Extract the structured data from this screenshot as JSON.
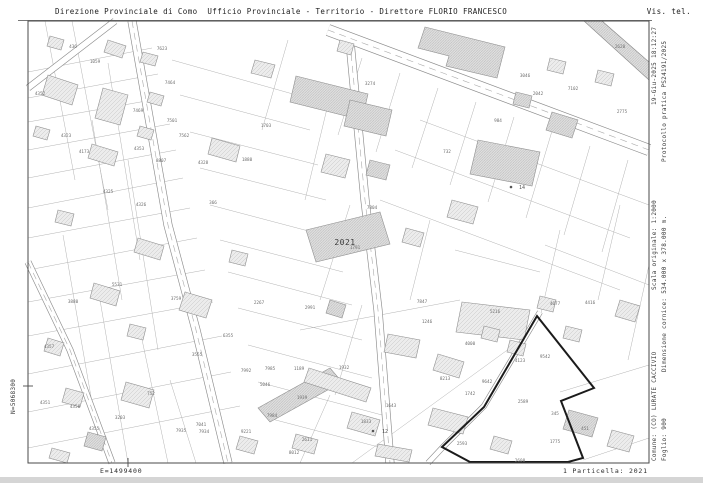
{
  "header": {
    "title_left": "Direzione Provinciale di Como  Ufficio Provinciale - Territorio - Direttore FLORIO FRANCESCO",
    "title_right": "Vis. tel."
  },
  "margin_right": {
    "line1": [
      "Comune: (CO) LURATE CACCIVIO",
      "Scala originale: 1:2000",
      "19-Giu-2025 18:12:27"
    ],
    "line2": [
      "Foglio: 900",
      "Dimensione cornice: 534.000 x 378.000 m.",
      "Protocollo pratica PS24191/2025"
    ]
  },
  "margin_left": {
    "north_coord": "N=5068300"
  },
  "footer": {
    "east_coord": "E=1499400",
    "parcel_ref": "1 Particella: 2021"
  },
  "colors": {
    "frame": "#4a4a4a",
    "parcel_line": "#b3b3b3",
    "road_edge": "#8c8c8c",
    "building_stroke": "#909090",
    "building_fill": "#ececec",
    "building_fill_dense": "#e0e0e0",
    "hatch": "#c6c6c6",
    "hatch_dense": "#b2b2b2",
    "label": "#6e6e6e",
    "bold_boundary": "#1b1b1b",
    "highlight_label": "#3a3a3a"
  },
  "map": {
    "frame": {
      "x": 28,
      "y": 21,
      "w": 621,
      "h": 442
    },
    "header_rule": {
      "x1": 18,
      "y1": 20.5,
      "x2": 652,
      "y2": 20.5
    },
    "ticks": [
      {
        "x1": 128,
        "y1": 458,
        "x2": 128,
        "y2": 467
      },
      {
        "x1": 23,
        "y1": 386,
        "x2": 33,
        "y2": 386
      }
    ],
    "highlight_parcel": {
      "label": "2021",
      "x": 345,
      "y": 245
    },
    "bold_boundary": "537,316 594,388 561,401 583,458 568,462 470,462 442,447 484,407",
    "railway_band": "584,21 602,21 649,62 649,80",
    "roads": [
      {
        "points": "132,21 168,225 196,330 228,463",
        "w": 9,
        "dashed": true
      },
      {
        "points": "28,262 70,350 112,463",
        "w": 7,
        "dashed": true
      },
      {
        "points": "28,88 115,21",
        "w": 7,
        "dashed": false
      },
      {
        "points": "350,42 365,200 378,310 390,463",
        "w": 9,
        "dashed": true
      },
      {
        "points": "328,30 649,150",
        "w": 12,
        "dashed": true
      },
      {
        "points": "540,312 484,406 443,447 428,463",
        "w": 6,
        "dashed": false
      }
    ],
    "parcel_lines": [
      [
        152,
        48,
        28,
        72
      ],
      [
        158,
        74,
        28,
        98
      ],
      [
        163,
        98,
        28,
        122
      ],
      [
        170,
        124,
        28,
        150
      ],
      [
        176,
        150,
        28,
        178
      ],
      [
        183,
        178,
        28,
        208
      ],
      [
        190,
        208,
        28,
        238
      ],
      [
        197,
        238,
        28,
        270
      ],
      [
        205,
        270,
        28,
        302
      ],
      [
        213,
        302,
        28,
        336
      ],
      [
        222,
        336,
        28,
        374
      ],
      [
        231,
        372,
        28,
        412
      ],
      [
        240,
        406,
        28,
        448
      ],
      [
        72,
        21,
        108,
        210
      ],
      [
        45,
        21,
        75,
        180
      ],
      [
        108,
        63,
        140,
        260
      ],
      [
        92,
        120,
        122,
        300
      ],
      [
        128,
        160,
        158,
        350
      ],
      [
        63,
        235,
        95,
        420
      ],
      [
        100,
        300,
        128,
        463
      ],
      [
        140,
        330,
        168,
        463
      ],
      [
        170,
        380,
        196,
        463
      ],
      [
        172,
        60,
        300,
        96
      ],
      [
        180,
        95,
        310,
        130
      ],
      [
        190,
        132,
        318,
        165
      ],
      [
        200,
        168,
        326,
        200
      ],
      [
        210,
        205,
        335,
        238
      ],
      [
        220,
        240,
        343,
        272
      ],
      [
        228,
        272,
        352,
        305
      ],
      [
        238,
        308,
        362,
        340
      ],
      [
        248,
        345,
        372,
        378
      ],
      [
        258,
        382,
        382,
        415
      ],
      [
        268,
        418,
        390,
        450
      ],
      [
        262,
        130,
        288,
        40
      ],
      [
        305,
        200,
        330,
        96
      ],
      [
        320,
        300,
        350,
        205
      ],
      [
        335,
        395,
        362,
        305
      ],
      [
        300,
        463,
        330,
        395
      ],
      [
        395,
        150,
        630,
        238
      ],
      [
        380,
        200,
        620,
        290
      ],
      [
        545,
        245,
        649,
        285
      ],
      [
        420,
        120,
        649,
        205
      ],
      [
        362,
        58,
        338,
        135
      ],
      [
        400,
        73,
        376,
        152
      ],
      [
        438,
        88,
        412,
        168
      ],
      [
        476,
        102,
        450,
        185
      ],
      [
        514,
        117,
        488,
        202
      ],
      [
        552,
        131,
        526,
        218
      ],
      [
        590,
        146,
        564,
        235
      ],
      [
        628,
        160,
        602,
        252
      ],
      [
        620,
        205,
        598,
        300
      ],
      [
        649,
        265,
        628,
        360
      ],
      [
        560,
        230,
        540,
        318
      ],
      [
        560,
        392,
        649,
        365
      ],
      [
        583,
        460,
        649,
        438
      ],
      [
        352,
        463,
        528,
        335
      ],
      [
        455,
        250,
        540,
        272
      ],
      [
        300,
        330,
        460,
        300
      ],
      [
        410,
        300,
        430,
        220
      ]
    ],
    "buildings": [
      {
        "p": "50,36 64,40 61,50 47,46",
        "d": 0
      },
      {
        "p": "108,40 126,46 122,58 104,52",
        "d": 0
      },
      {
        "p": "143,52 158,56 155,66 140,62",
        "d": 0
      },
      {
        "p": "48,75 78,85 72,105 42,95",
        "d": 0
      },
      {
        "p": "36,126 50,130 47,140 33,136",
        "d": 0
      },
      {
        "p": "150,92 164,96 161,106 147,102",
        "d": 0
      },
      {
        "p": "92,144 118,152 114,166 88,158",
        "d": 0
      },
      {
        "p": "140,126 154,130 151,140 137,136",
        "d": 0
      },
      {
        "p": "212,138 240,146 236,162 208,154",
        "d": 0
      },
      {
        "p": "58,210 74,214 71,226 55,222",
        "d": 0
      },
      {
        "p": "138,238 164,246 160,260 134,252",
        "d": 0
      },
      {
        "p": "94,283 120,291 116,306 90,298",
        "d": 0
      },
      {
        "p": "130,324 146,328 143,340 127,336",
        "d": 0
      },
      {
        "p": "48,338 64,343 60,356 44,351",
        "d": 0
      },
      {
        "p": "66,388 84,393 80,407 62,402",
        "d": 0
      },
      {
        "p": "126,382 154,390 149,408 121,400",
        "d": 0
      },
      {
        "p": "88,432 106,437 102,451 84,446",
        "d": 1
      },
      {
        "p": "52,448 70,453 67,463 49,458",
        "d": 0
      },
      {
        "p": "296,76 368,94 362,120 290,102",
        "d": 1
      },
      {
        "p": "350,100 392,110 386,136 344,126",
        "d": 1
      },
      {
        "p": "306,230 380,212 390,244 316,262",
        "d": 1
      },
      {
        "p": "103,88 128,95 120,125 95,118",
        "d": 0
      },
      {
        "p": "425,27 505,47 497,78 446,66 449,56 418,48",
        "d": 1
      },
      {
        "p": "478,140 540,152 532,186 470,174",
        "d": 1
      },
      {
        "p": "552,112 578,120 572,138 546,130",
        "d": 1
      },
      {
        "p": "550,58 566,62 563,74 547,70",
        "d": 0
      },
      {
        "p": "598,70 614,74 611,86 595,82",
        "d": 0
      },
      {
        "p": "516,92 532,96 529,108 513,104",
        "d": 1
      },
      {
        "p": "462,302 530,310 524,340 456,332",
        "d": 0
      },
      {
        "p": "484,326 500,330 497,342 481,338",
        "d": 0
      },
      {
        "p": "438,354 464,362 459,378 433,370",
        "d": 0
      },
      {
        "p": "510,340 526,344 523,356 507,352",
        "d": 0
      },
      {
        "p": "540,296 556,300 553,312 537,308",
        "d": 0
      },
      {
        "p": "566,326 582,330 579,342 563,338",
        "d": 0
      },
      {
        "p": "569,410 598,418 592,437 563,429",
        "d": 1
      },
      {
        "p": "433,408 468,417 463,434 428,425",
        "d": 0
      },
      {
        "p": "494,436 512,441 508,454 490,449",
        "d": 0
      },
      {
        "p": "258,408 330,368 342,382 270,422",
        "d": 1
      },
      {
        "p": "309,368 371,388 366,402 304,382",
        "d": 0
      },
      {
        "p": "388,334 420,340 416,358 384,352",
        "d": 0
      },
      {
        "p": "378,444 412,450 409,462 375,456",
        "d": 0
      },
      {
        "p": "352,412 380,420 375,436 347,428",
        "d": 0
      },
      {
        "p": "296,434 318,440 314,454 292,448",
        "d": 0
      },
      {
        "p": "240,436 258,441 254,454 236,449",
        "d": 0
      },
      {
        "p": "185,292 212,300 206,318 179,310",
        "d": 0
      },
      {
        "p": "232,250 248,254 245,266 229,262",
        "d": 0
      },
      {
        "p": "330,300 346,305 342,318 326,313",
        "d": 1
      },
      {
        "p": "326,154 350,160 345,178 321,172",
        "d": 0
      },
      {
        "p": "370,160 390,165 386,180 366,175",
        "d": 1
      },
      {
        "p": "255,60 275,65 271,78 251,73",
        "d": 0
      },
      {
        "p": "340,40 354,44 351,55 337,51",
        "d": 0
      },
      {
        "p": "620,300 640,306 635,322 615,316",
        "d": 0
      },
      {
        "p": "612,430 634,436 629,452 607,446",
        "d": 0
      },
      {
        "p": "452,200 478,207 473,224 447,217",
        "d": 0
      },
      {
        "p": "406,228 424,233 420,247 402,242",
        "d": 0
      }
    ],
    "labels": [
      {
        "t": "436",
        "x": 73,
        "y": 48
      },
      {
        "t": "1059",
        "x": 95,
        "y": 63
      },
      {
        "t": "7623",
        "x": 162,
        "y": 50
      },
      {
        "t": "4352",
        "x": 40,
        "y": 95
      },
      {
        "t": "7464",
        "x": 170,
        "y": 84
      },
      {
        "t": "7469",
        "x": 138,
        "y": 112
      },
      {
        "t": "7501",
        "x": 172,
        "y": 122
      },
      {
        "t": "7562",
        "x": 184,
        "y": 137
      },
      {
        "t": "4323",
        "x": 66,
        "y": 137
      },
      {
        "t": "4173",
        "x": 84,
        "y": 153
      },
      {
        "t": "4353",
        "x": 139,
        "y": 150
      },
      {
        "t": "8807",
        "x": 161,
        "y": 162
      },
      {
        "t": "4328",
        "x": 203,
        "y": 164
      },
      {
        "t": "4325",
        "x": 108,
        "y": 193
      },
      {
        "t": "4326",
        "x": 141,
        "y": 206
      },
      {
        "t": "366",
        "x": 213,
        "y": 204
      },
      {
        "t": "1703",
        "x": 266,
        "y": 127
      },
      {
        "t": "1880",
        "x": 247,
        "y": 161
      },
      {
        "t": "3274",
        "x": 370,
        "y": 85
      },
      {
        "t": "2620",
        "x": 620,
        "y": 48
      },
      {
        "t": "3046",
        "x": 525,
        "y": 77
      },
      {
        "t": "2042",
        "x": 538,
        "y": 95
      },
      {
        "t": "7102",
        "x": 573,
        "y": 90
      },
      {
        "t": "2775",
        "x": 622,
        "y": 113
      },
      {
        "t": "984",
        "x": 498,
        "y": 122
      },
      {
        "t": "732",
        "x": 447,
        "y": 153
      },
      {
        "t": "7804",
        "x": 372,
        "y": 209
      },
      {
        "t": "1791",
        "x": 355,
        "y": 249
      },
      {
        "t": "2267",
        "x": 259,
        "y": 304
      },
      {
        "t": "2991",
        "x": 310,
        "y": 309
      },
      {
        "t": "7847",
        "x": 422,
        "y": 303
      },
      {
        "t": "1246",
        "x": 427,
        "y": 323
      },
      {
        "t": "7992",
        "x": 246,
        "y": 372
      },
      {
        "t": "7985",
        "x": 270,
        "y": 370
      },
      {
        "t": "5046",
        "x": 265,
        "y": 386
      },
      {
        "t": "1189",
        "x": 299,
        "y": 370
      },
      {
        "t": "1939",
        "x": 302,
        "y": 399
      },
      {
        "t": "1932",
        "x": 344,
        "y": 369
      },
      {
        "t": "7984",
        "x": 272,
        "y": 417
      },
      {
        "t": "9221",
        "x": 246,
        "y": 433
      },
      {
        "t": "2611",
        "x": 307,
        "y": 441
      },
      {
        "t": "1643",
        "x": 391,
        "y": 407
      },
      {
        "t": "1833",
        "x": 366,
        "y": 423
      },
      {
        "t": "8012",
        "x": 294,
        "y": 454
      },
      {
        "t": "5531",
        "x": 117,
        "y": 286
      },
      {
        "t": "3880",
        "x": 73,
        "y": 303
      },
      {
        "t": "3759",
        "x": 176,
        "y": 300
      },
      {
        "t": "4357",
        "x": 49,
        "y": 348
      },
      {
        "t": "6355",
        "x": 228,
        "y": 337
      },
      {
        "t": "3555",
        "x": 197,
        "y": 356
      },
      {
        "t": "752",
        "x": 151,
        "y": 395
      },
      {
        "t": "4351",
        "x": 45,
        "y": 404
      },
      {
        "t": "4350",
        "x": 75,
        "y": 408
      },
      {
        "t": "4355",
        "x": 94,
        "y": 430
      },
      {
        "t": "3203",
        "x": 120,
        "y": 419
      },
      {
        "t": "7041",
        "x": 201,
        "y": 426
      },
      {
        "t": "7935",
        "x": 181,
        "y": 432
      },
      {
        "t": "7934",
        "x": 204,
        "y": 433
      },
      {
        "t": "5216",
        "x": 495,
        "y": 313
      },
      {
        "t": "4077",
        "x": 555,
        "y": 305
      },
      {
        "t": "4416",
        "x": 590,
        "y": 304
      },
      {
        "t": "4000",
        "x": 470,
        "y": 345
      },
      {
        "t": "9542",
        "x": 545,
        "y": 358
      },
      {
        "t": "4123",
        "x": 520,
        "y": 362
      },
      {
        "t": "8213",
        "x": 445,
        "y": 380
      },
      {
        "t": "9642",
        "x": 487,
        "y": 383
      },
      {
        "t": "1742",
        "x": 470,
        "y": 395
      },
      {
        "t": "2589",
        "x": 523,
        "y": 403
      },
      {
        "t": "345",
        "x": 555,
        "y": 415
      },
      {
        "t": "451",
        "x": 585,
        "y": 430
      },
      {
        "t": "1775",
        "x": 555,
        "y": 443
      },
      {
        "t": "2608",
        "x": 520,
        "y": 462
      },
      {
        "t": "2593",
        "x": 462,
        "y": 445
      }
    ],
    "markers": [
      {
        "t": "14",
        "x": 519,
        "y": 189,
        "cx": 511,
        "cy": 187
      },
      {
        "t": "12",
        "x": 382,
        "y": 433,
        "cx": 373,
        "cy": 431
      }
    ]
  }
}
